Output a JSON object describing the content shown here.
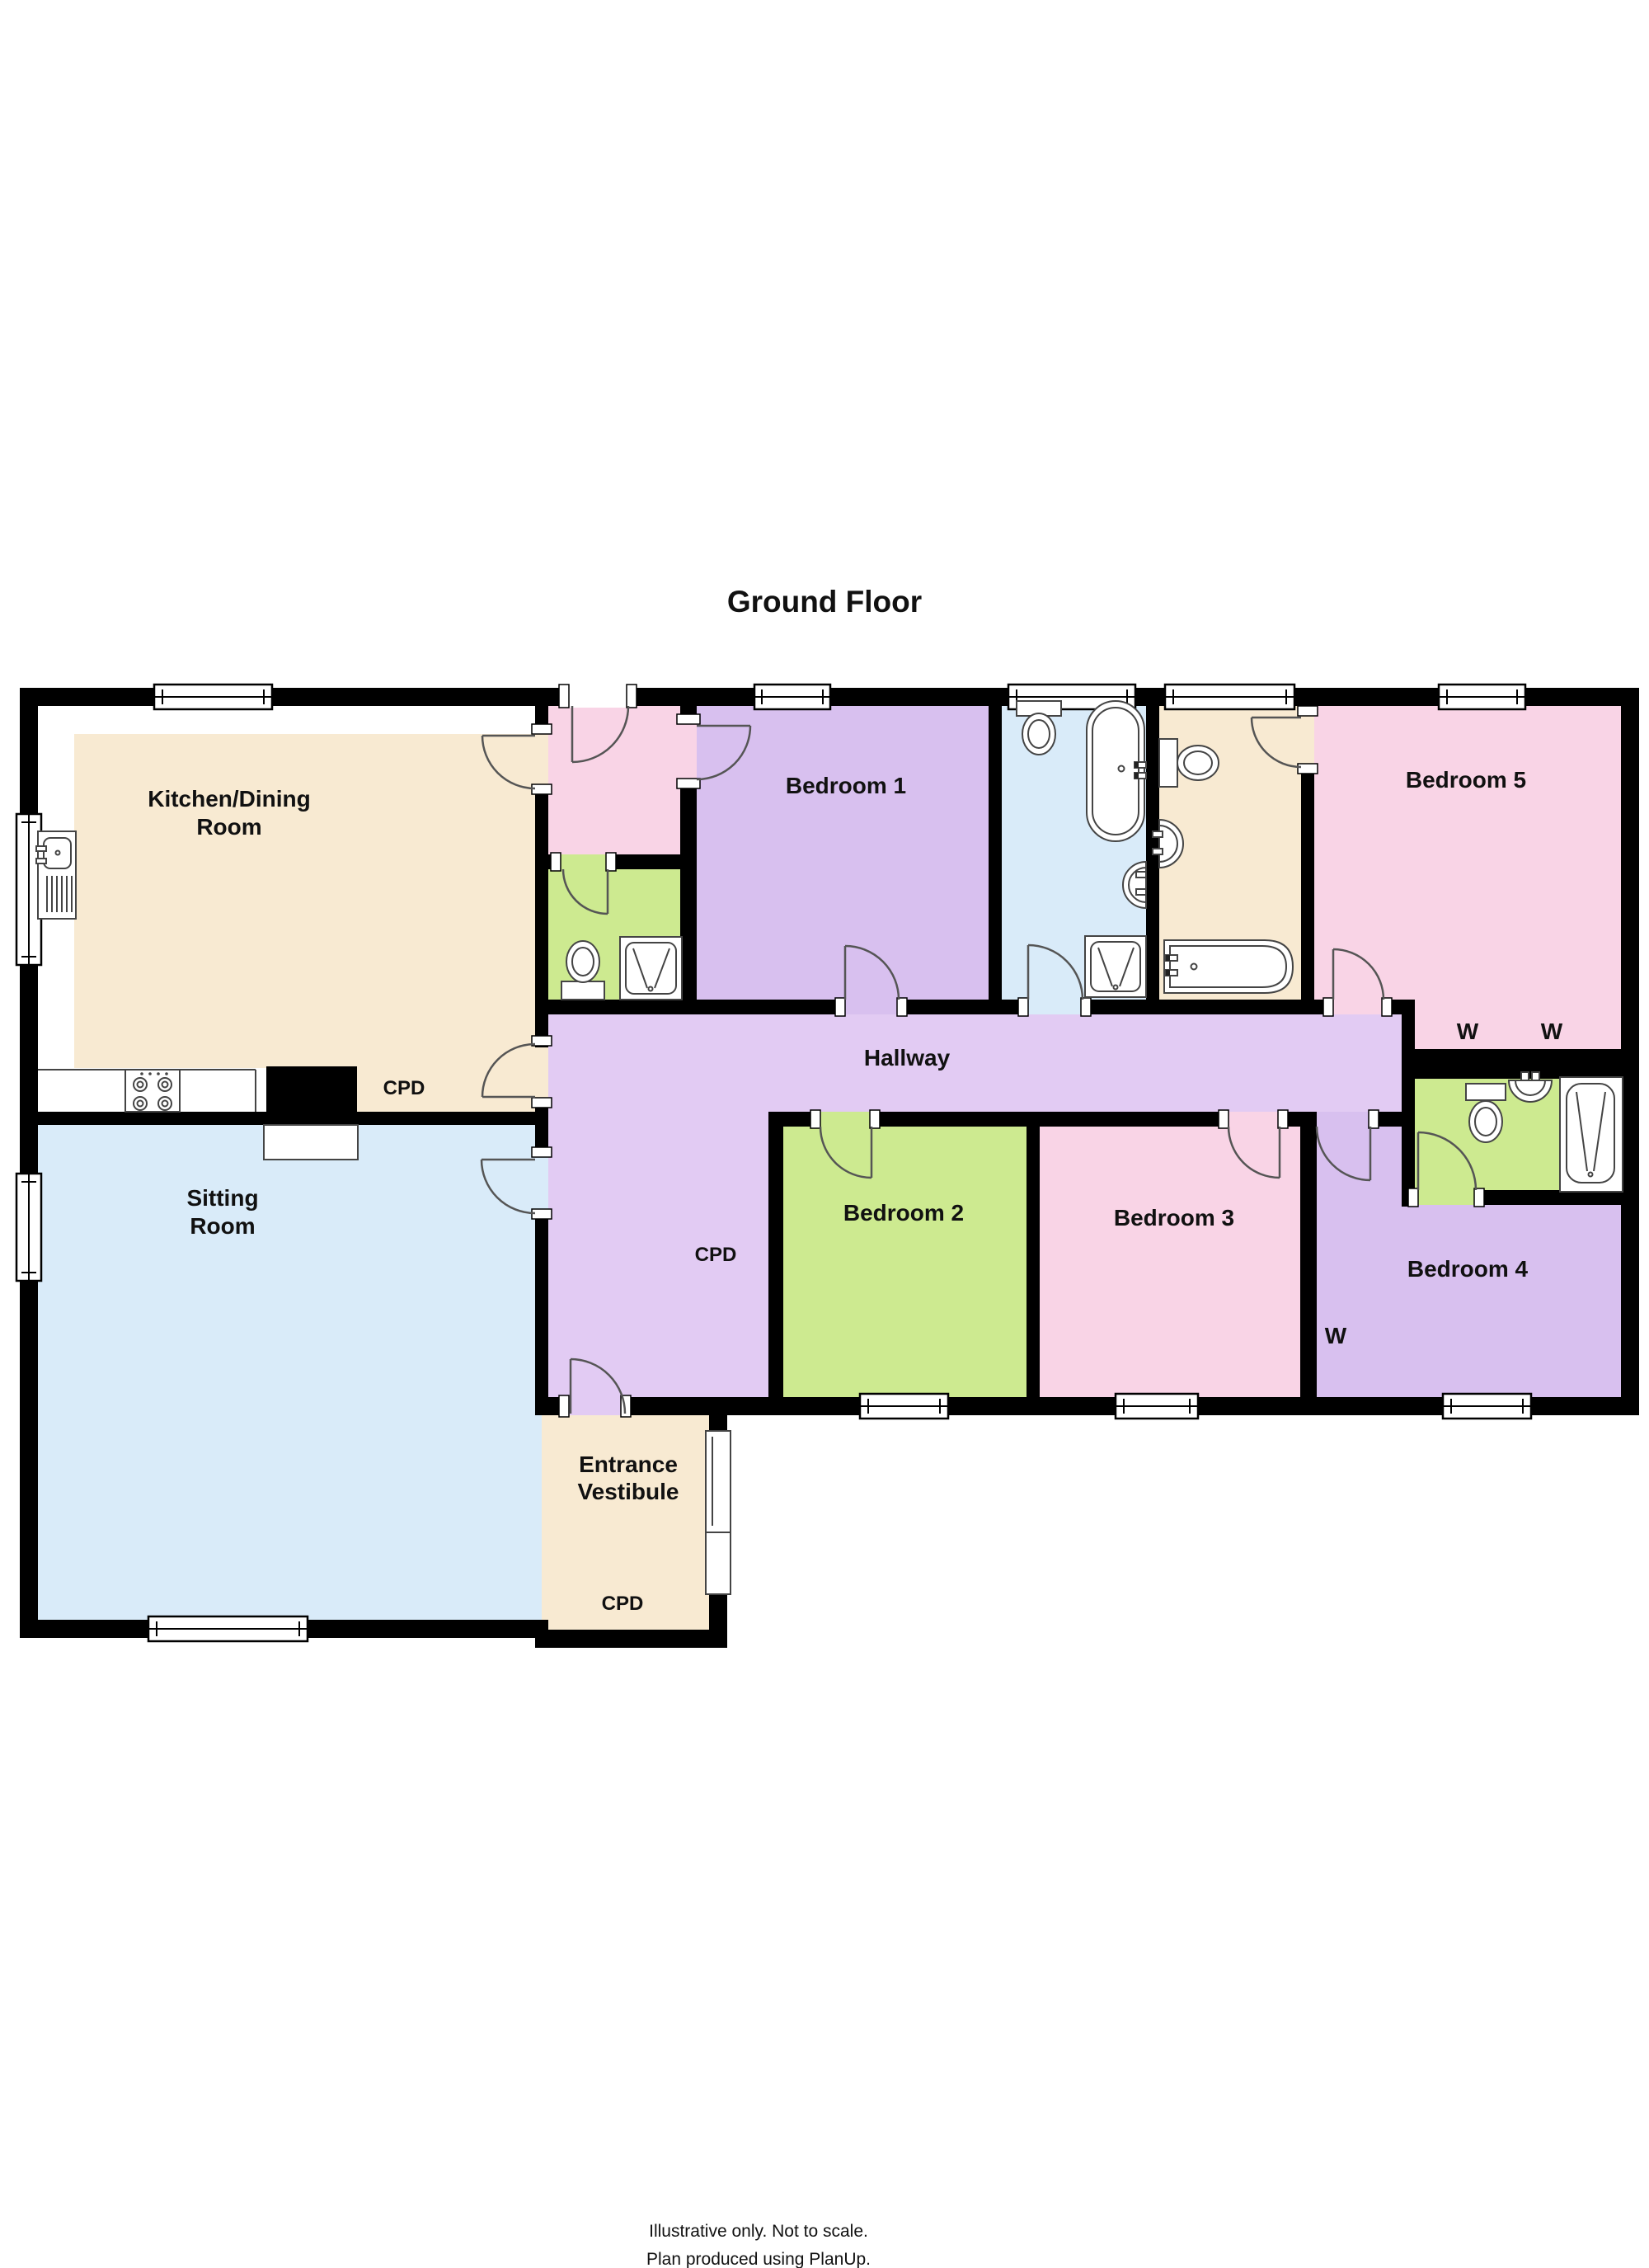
{
  "title": "Ground Floor",
  "colors": {
    "wall": "#000000",
    "cream": "#F8EAD2",
    "blue": "#D9EBF9",
    "purple": "#D8C0EF",
    "hallway_purple": "#E2CBF3",
    "pink": "#F9D4E6",
    "green": "#CDEA90",
    "white": "#FFFFFF"
  },
  "rooms": {
    "kitchen": {
      "line1": "Kitchen/Dining",
      "line2": "Room"
    },
    "sitting": {
      "line1": "Sitting",
      "line2": "Room"
    },
    "vestibule": {
      "line1": "Entrance",
      "line2": "Vestibule"
    },
    "bedroom1": {
      "label": "Bedroom 1"
    },
    "bedroom2": {
      "label": "Bedroom 2"
    },
    "bedroom3": {
      "label": "Bedroom 3"
    },
    "bedroom4": {
      "label": "Bedroom 4"
    },
    "bedroom5": {
      "label": "Bedroom 5"
    },
    "hallway": {
      "label": "Hallway"
    }
  },
  "annotations": {
    "cupboard": "CPD",
    "wardrobe": "W"
  },
  "footer": {
    "line1": "Illustrative only.  Not to scale.",
    "line2": "Plan produced using PlanUp."
  }
}
